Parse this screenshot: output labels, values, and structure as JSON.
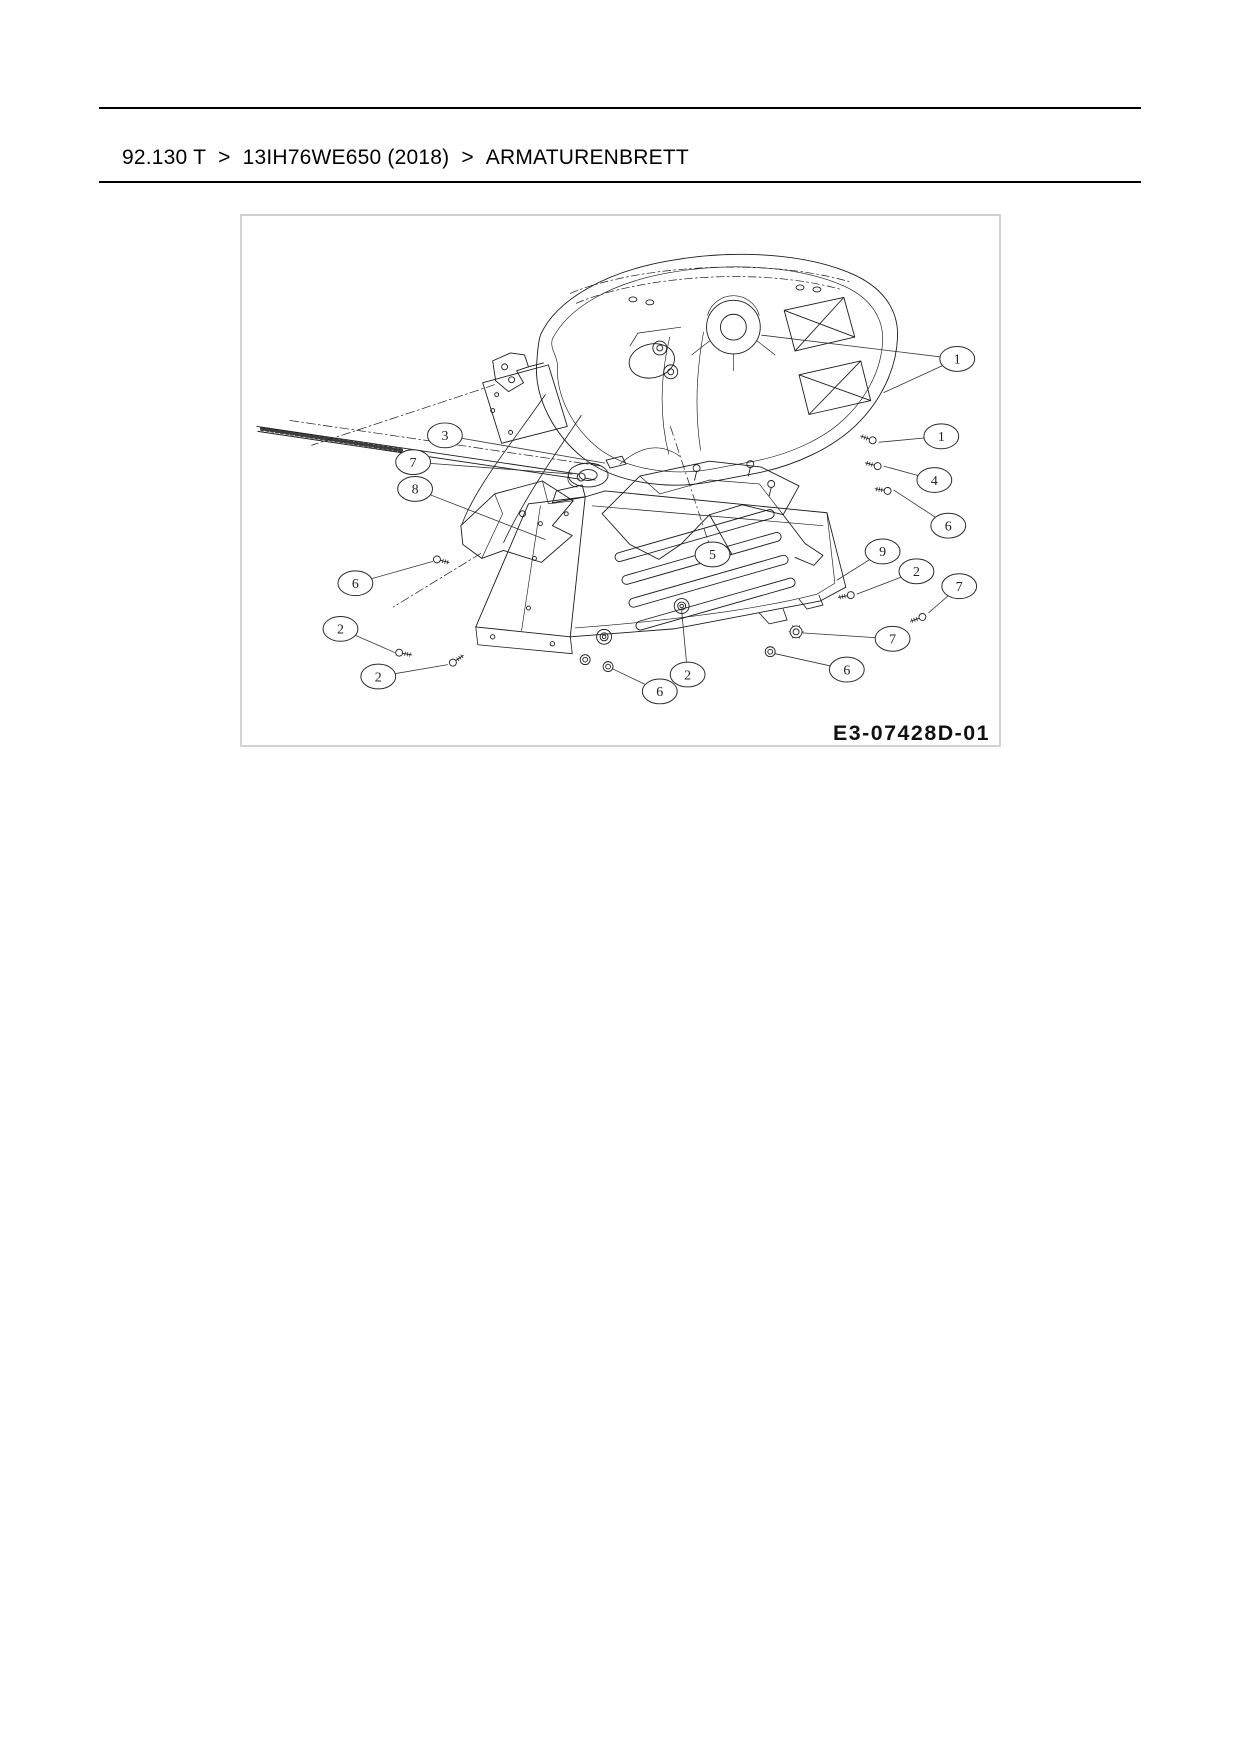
{
  "page": {
    "background": "#ffffff",
    "type": "parts-catalog-page"
  },
  "colors": {
    "line": "#1b1b1b",
    "leader": "#333333",
    "box_border": "#d2d2d2",
    "text": "#000000"
  },
  "breadcrumb": {
    "items": [
      "92.130 T",
      "13IH76WE650 (2018)",
      "ARMATURENBRETT"
    ],
    "separator": ">"
  },
  "diagram": {
    "code": "E3-07428D-01",
    "callouts": [
      {
        "label": "1",
        "cx": 719,
        "cy": 144,
        "leaders": [
          [
            522,
            120
          ],
          [
            645,
            178
          ]
        ]
      },
      {
        "label": "1",
        "cx": 703,
        "cy": 222,
        "leaders": [
          [
            640,
            228
          ]
        ]
      },
      {
        "label": "4",
        "cx": 696,
        "cy": 266,
        "leaders": [
          [
            645,
            252
          ]
        ]
      },
      {
        "label": "6",
        "cx": 710,
        "cy": 312,
        "leaders": [
          [
            655,
            276
          ]
        ]
      },
      {
        "label": "9",
        "cx": 644,
        "cy": 338,
        "leaders": [
          [
            598,
            367
          ]
        ]
      },
      {
        "label": "2",
        "cx": 678,
        "cy": 358,
        "leaders": [
          [
            618,
            381
          ]
        ]
      },
      {
        "label": "7",
        "cx": 721,
        "cy": 373,
        "leaders": [
          [
            690,
            400
          ]
        ]
      },
      {
        "label": "7",
        "cx": 654,
        "cy": 426,
        "leaders": [
          [
            563,
            420
          ]
        ]
      },
      {
        "label": "6",
        "cx": 608,
        "cy": 457,
        "leaders": [
          [
            536,
            441
          ]
        ]
      },
      {
        "label": "3",
        "cx": 204,
        "cy": 221,
        "leaders": [
          [
            365,
            249
          ]
        ]
      },
      {
        "label": "7",
        "cx": 172,
        "cy": 248,
        "leaders": [
          [
            332,
            260
          ]
        ]
      },
      {
        "label": "8",
        "cx": 174,
        "cy": 275,
        "leaders": [
          [
            305,
            326
          ]
        ]
      },
      {
        "label": "6",
        "cx": 114,
        "cy": 370,
        "leaders": [
          [
            192,
            348
          ]
        ]
      },
      {
        "label": "2",
        "cx": 99,
        "cy": 416,
        "leaders": [
          [
            154,
            440
          ]
        ]
      },
      {
        "label": "2",
        "cx": 137,
        "cy": 464,
        "leaders": [
          [
            207,
            452
          ]
        ]
      },
      {
        "label": "5",
        "cx": 473,
        "cy": 341,
        "leaders": [
          [
            430,
            210
          ]
        ],
        "dash": true
      },
      {
        "label": "2",
        "cx": 448,
        "cy": 462,
        "leaders": [
          [
            442,
            398
          ]
        ]
      },
      {
        "label": "6",
        "cx": 420,
        "cy": 479,
        "leaders": [
          [
            372,
            456
          ]
        ]
      }
    ]
  }
}
